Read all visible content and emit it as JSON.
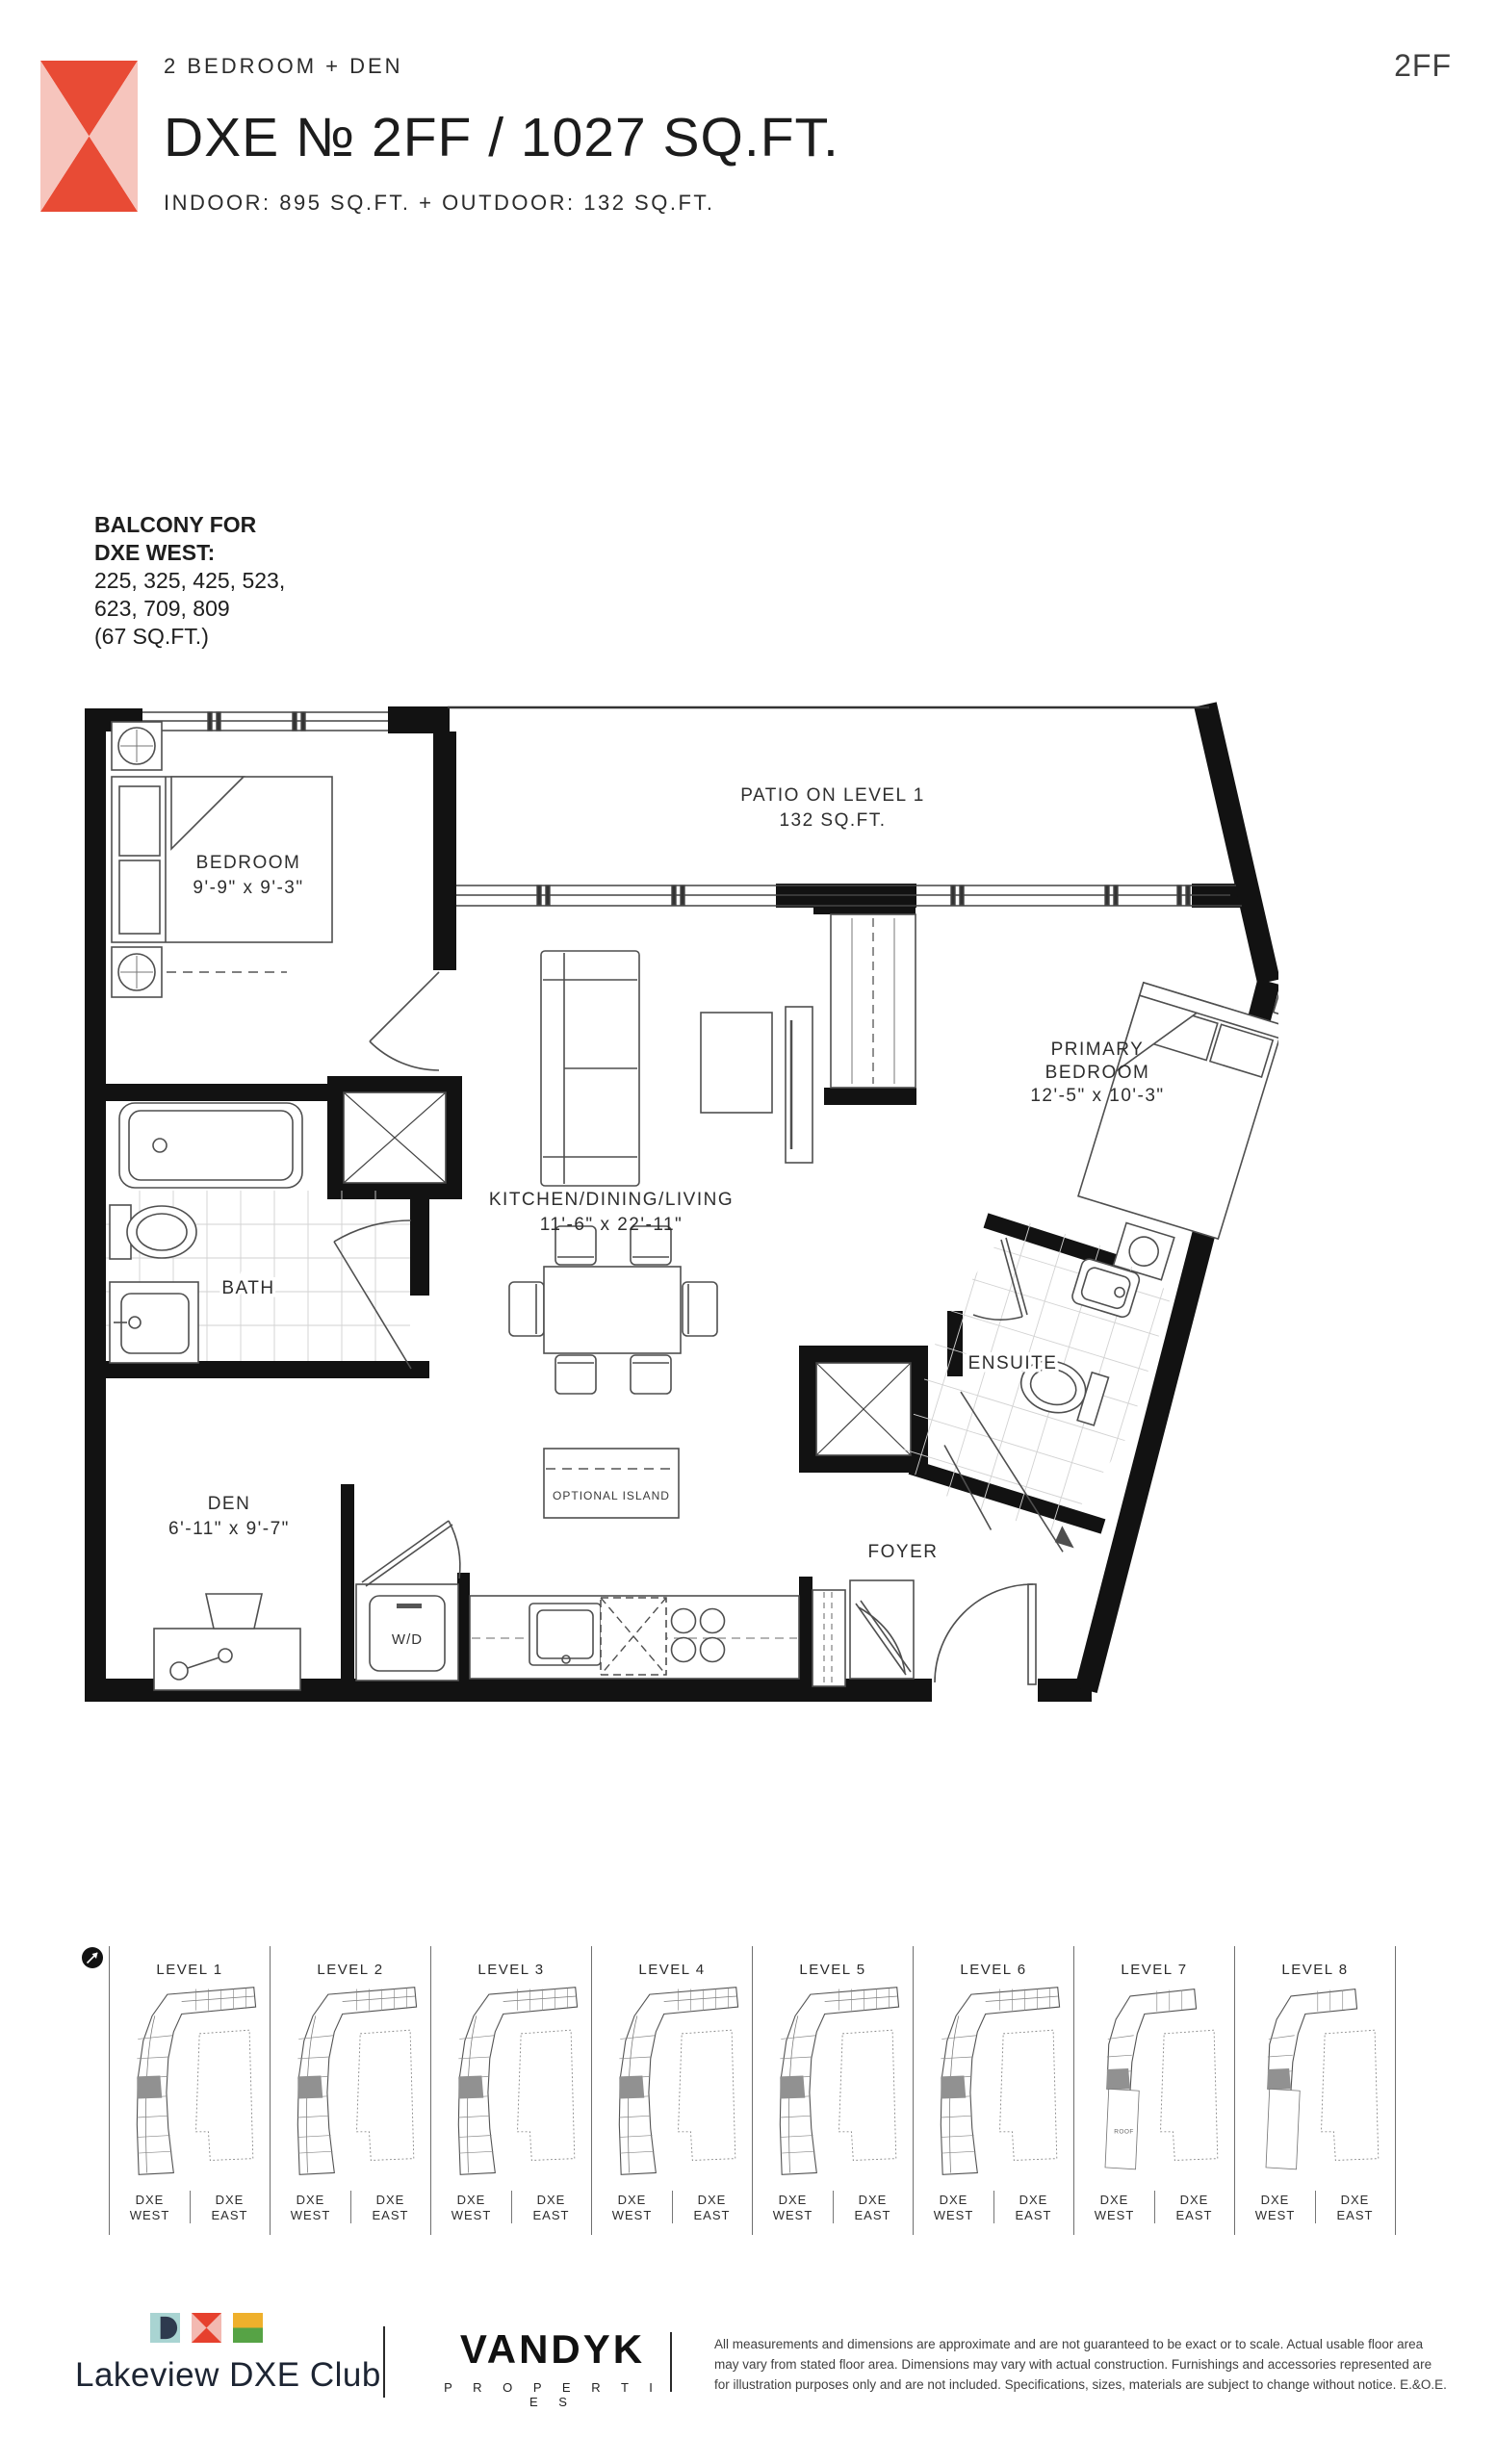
{
  "header": {
    "eyebrow": "2 BEDROOM + DEN",
    "title": "DXE № 2FF / 1027 SQ.FT.",
    "subtitle": "INDOOR: 895 SQ.FT. + OUTDOOR: 132 SQ.FT.",
    "unit_code": "2FF",
    "logo_icon": "dxe-x-mark"
  },
  "balcony_note": {
    "heading_line1": "BALCONY FOR",
    "heading_line2": "DXE WEST:",
    "body_line1": "225, 325, 425, 523,",
    "body_line2": "623, 709, 809",
    "body_line3": "(67 SQ.FT.)"
  },
  "floorplan": {
    "patio_name": "PATIO ON LEVEL 1",
    "patio_dims": "132 SQ.FT.",
    "bedroom_name": "BEDROOM",
    "bedroom_dims": "9'-9\" x 9'-3\"",
    "primary_line1": "PRIMARY",
    "primary_line2": "BEDROOM",
    "primary_dims": "12'-5\" x 10'-3\"",
    "kitchen_name": "KITCHEN/DINING/LIVING",
    "kitchen_dims": "11'-6\" x 22'-11\"",
    "bath_name": "BATH",
    "ensuite_name": "ENSUITE",
    "den_name": "DEN",
    "den_dims": "6'-11\" x 9'-7\"",
    "foyer_name": "FOYER",
    "wd_name": "W/D",
    "island_name": "OPTIONAL ISLAND"
  },
  "key_plans": {
    "north_icon": "north-arrow",
    "roof_label": "ROOF",
    "brand": "DXE",
    "west": "WEST",
    "east": "EAST",
    "levels": [
      {
        "label": "LEVEL 1"
      },
      {
        "label": "LEVEL 2"
      },
      {
        "label": "LEVEL 3"
      },
      {
        "label": "LEVEL 4"
      },
      {
        "label": "LEVEL 5"
      },
      {
        "label": "LEVEL 6"
      },
      {
        "label": "LEVEL 7"
      },
      {
        "label": "LEVEL 8"
      }
    ]
  },
  "footer": {
    "lakeview_logo_icon": "dxe-letter-tiles",
    "lakeview_wordmark": "Lakeview DXE Club",
    "vandyk_wordmark": "VANDYK",
    "vandyk_sub": "P R O P E R T I E S",
    "disclaimer": "All measurements and dimensions are approximate and are not guaranteed to be exact or to scale. Actual usable floor area may vary from stated floor area. Dimensions may vary with actual construction. Furnishings and accessories represented are for illustration purposes only and are not included. Specifications, sizes, materials are subject to change without notice. E.&O.E."
  },
  "colors": {
    "brand_red": "#e84b35",
    "brand_pink": "#f6c5bd",
    "tile_teal": "#a9d4d2",
    "tile_navy": "#2e3a4e",
    "tile_pink": "#f3b9b1",
    "tile_red": "#e6402d",
    "tile_yellow": "#efb02c",
    "tile_green": "#56a345",
    "ink": "#231f20",
    "wall": "#121212",
    "line": "#4f4f4f"
  }
}
